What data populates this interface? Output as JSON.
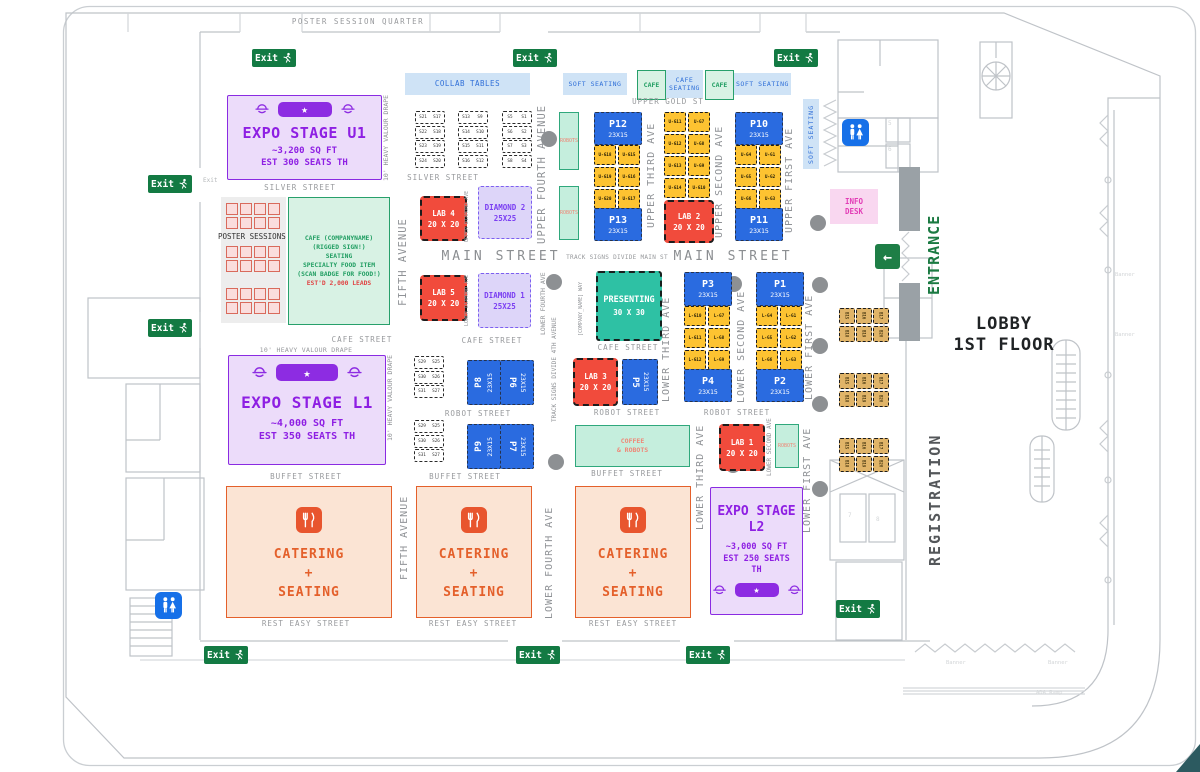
{
  "page": {
    "quarter": "POSTER SESSION QUARTER",
    "lobby_line1": "LOBBY",
    "lobby_line2": "1ST FLOOR",
    "entrance": "ENTRANCE",
    "registration": "REGISTRATION",
    "exit": "Exit",
    "banner": "Banner",
    "ada_ramp": "ADA Ramp"
  },
  "bars": {
    "collab": "COLLAB TABLES",
    "soft_seating": "SOFT SEATING",
    "cafe": "CAFE",
    "cafe_seating_line1": "CAFE",
    "cafe_seating_line2": "SEATING"
  },
  "streets": {
    "silver": "SILVER STREET",
    "upper_gold": "UPPER GOLD ST",
    "main": "MAIN STREET",
    "cafe": "CAFE STREET",
    "robot": "ROBOT STREET",
    "buffet": "BUFFET STREET",
    "rest_easy": "REST EASY STREET"
  },
  "avenues": {
    "fifth": "FIFTH AVENUE",
    "upper_fourth": "UPPER FOURTH AVENUE",
    "lower_fourth": "LOWER FOURTH AVE",
    "upper_third": "UPPER THIRD AVE",
    "upper_second": "UPPER SECOND AVE",
    "upper_first": "UPPER FIRST AVE",
    "lower_third": "LOWER THIRD AVE",
    "lower_second": "LOWER SECOND AVE",
    "lower_first": "LOWER FIRST AVE",
    "upper_diamond": "UPPER DIAMOND AVE",
    "lower_diamond": "LOWER DIAMOND AVE"
  },
  "notes": {
    "track_main": "TRACK SIGNS DIVIDE MAIN ST",
    "track_fourth": "TRACK SIGNS DIVIDE 4TH AVENUE",
    "company_way": "[COMPANY_NAME] WAY",
    "drape": "10' HEAVY VALOUR DRAPE"
  },
  "stages": {
    "u1_name": "EXPO STAGE U1",
    "u1_sqft": "~3,200 SQ FT",
    "u1_seats": "EST 300 SEATS TH",
    "l1_name": "EXPO STAGE L1",
    "l1_sqft": "~4,000 SQ FT",
    "l1_seats": "EST 350 SEATS TH",
    "l2_name_line1": "EXPO STAGE",
    "l2_name_line2": "L2",
    "l2_sqft": "~3,000 SQ FT",
    "l2_seats_line1": "EST 250 SEATS",
    "l2_seats_line2": "TH"
  },
  "poster_label": "POSTER SESSIONS",
  "cafe_block": {
    "line1": "CAFE (COMPANYNAME)",
    "line2": "(RIGGED SIGN!)",
    "line3": "SEATING",
    "line4": "SPECIALTY FOOD ITEM",
    "line5": "(SCAN BADGE FOR FOOD!)",
    "line6": "EST'D 2,000 LEADS"
  },
  "presenting": {
    "name": "PRESENTING",
    "size": "30 X 30"
  },
  "pavilions": {
    "size": "23X15",
    "p1": "P1",
    "p2": "P2",
    "p3": "P3",
    "p4": "P4",
    "p5": "P5",
    "p6": "P6",
    "p7": "P7",
    "p8": "P8",
    "p9": "P9",
    "p10": "P10",
    "p11": "P11",
    "p12": "P12",
    "p13": "P13"
  },
  "labs": {
    "size": "20 X 20",
    "lab1": "LAB 1",
    "lab2": "LAB 2",
    "lab3": "LAB 3",
    "lab4": "LAB 4",
    "lab5": "LAB 5"
  },
  "diamonds": {
    "size": "25X25",
    "d1": "DIAMOND 1",
    "d2": "DIAMOND 2"
  },
  "catering": {
    "line1": "CATERING",
    "line2": "+",
    "line3": "SEATING"
  },
  "coffee_robots": {
    "line1": "COFFEE",
    "line2": "& ROBOTS"
  },
  "robots_label": "ROBOTS",
  "info_desk": {
    "line1": "INFO",
    "line2": "DESK"
  },
  "booths": {
    "silver_groups": [
      [
        [
          "S21",
          "S17"
        ],
        [
          "S22",
          "S18"
        ],
        [
          "S23",
          "S19"
        ],
        [
          "S24",
          "S20"
        ]
      ],
      [
        [
          "S13",
          "S9"
        ],
        [
          "S14",
          "S10"
        ],
        [
          "S15",
          "S11"
        ],
        [
          "S16",
          "S12"
        ]
      ],
      [
        [
          "S5",
          "S1"
        ],
        [
          "S6",
          "S2"
        ],
        [
          "S7",
          "S3"
        ],
        [
          "S8",
          "S4"
        ]
      ]
    ],
    "cafe_group": [
      [
        "S29",
        "S25"
      ],
      [
        "S30",
        "S26"
      ],
      [
        "S31",
        "S27"
      ]
    ],
    "upper_g_left": [
      [
        "U-G18",
        "U-G15"
      ],
      [
        "U-G19",
        "U-G16"
      ],
      [
        "U-G20",
        "U-G17"
      ]
    ],
    "upper_g_mid": [
      [
        "U-G11",
        "U-G7"
      ],
      [
        "U-G12",
        "U-G8"
      ],
      [
        "U-G13",
        "U-G9"
      ],
      [
        "U-G14",
        "U-G10"
      ]
    ],
    "upper_g_right": [
      [
        "U-G4",
        "U-G1"
      ],
      [
        "U-G5",
        "U-G2"
      ],
      [
        "U-G6",
        "U-G3"
      ]
    ],
    "lower_g_left": [
      [
        "L-G10",
        "L-G7"
      ],
      [
        "L-G11",
        "L-G8"
      ],
      [
        "L-G12",
        "L-G9"
      ]
    ],
    "lower_g_right": [
      [
        "L-G4",
        "L-G1"
      ],
      [
        "L-G5",
        "L-G2"
      ],
      [
        "L-G6",
        "L-G3"
      ]
    ],
    "b_cluster": [
      "B15",
      "B16",
      "B17",
      "B18",
      "B19",
      "B20"
    ]
  },
  "elevator_labels": {
    "e5": "5",
    "e6": "6",
    "e7": "7",
    "e8": "8"
  },
  "colors": {
    "pavilion_blue": "#2a6be0",
    "booth_yellow": "#fdc331",
    "lab_red": "#f14b3c",
    "presenting_teal": "#2ec1a4",
    "robots_teal_fill": "#c5eedd",
    "stage_purple": "#8e1fe3",
    "stage_fill": "#ecdcfa",
    "diamond_purple": "#7b3ff2",
    "catering_orange": "#e4602b",
    "soft_seating_blue": "#cfe3f6",
    "cafe_green": "#27a06b",
    "exit_green": "#137a43",
    "info_pink": "#f9d7f0",
    "restroom_blue": "#1670e8",
    "tan_booth": "#e0b468",
    "entrance_green": "#1b7a42"
  }
}
